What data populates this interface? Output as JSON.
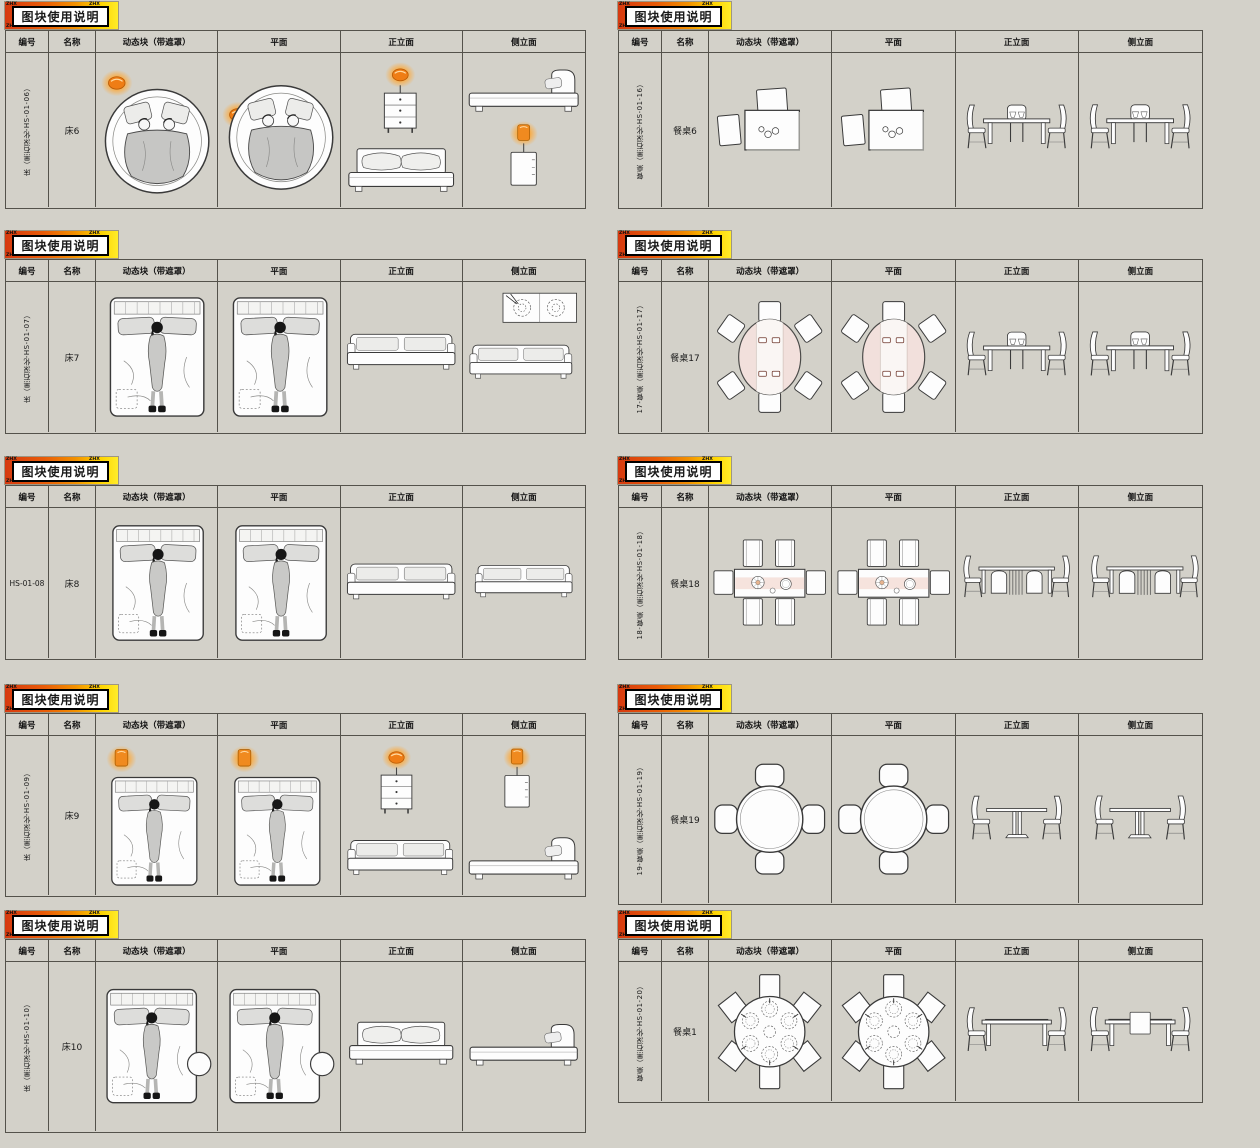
{
  "page": {
    "background_color": "#d3d1c9",
    "grid_line_color": "#54524b"
  },
  "banner": {
    "title": "图块使用说明",
    "corner_mark": "ZHX",
    "gradient_start": "#d63a10",
    "gradient_end": "#ffec2a"
  },
  "table": {
    "columns": [
      "编号",
      "名称",
      "动态块（带遮罩）",
      "平面",
      "正立面",
      "侧立面"
    ]
  },
  "accents": {
    "lamp_orange": "#f08a1f",
    "table_runner_pink": "#f2e0dc",
    "drawing_fill": "#fdfdfd"
  },
  "sections": [
    {
      "code": "床（黑石深化-HS-01-06）",
      "name": "床6"
    },
    {
      "code": "床（黑石深化-HS-01-07）",
      "name": "床7"
    },
    {
      "code": "HS-01-08",
      "name": "床8"
    },
    {
      "code": "床（黑石深化-HS-01-09）",
      "name": "床9"
    },
    {
      "code": "床（黑石深化-HS-01-10）",
      "name": "床10"
    },
    {
      "code": "餐桌（黑石深化-HS-01-16）",
      "name": "餐桌6"
    },
    {
      "code": "17-餐桌（黑石深化-HS-01-17）",
      "name": "餐桌17"
    },
    {
      "code": "18-餐桌（黑石深化-HS-01-18）",
      "name": "餐桌18"
    },
    {
      "code": "19-餐桌（黑石深化-HS-01-19）",
      "name": "餐桌19"
    },
    {
      "code": "餐桌（黑石深化-HS-01-20）",
      "name": "餐桌1"
    }
  ]
}
